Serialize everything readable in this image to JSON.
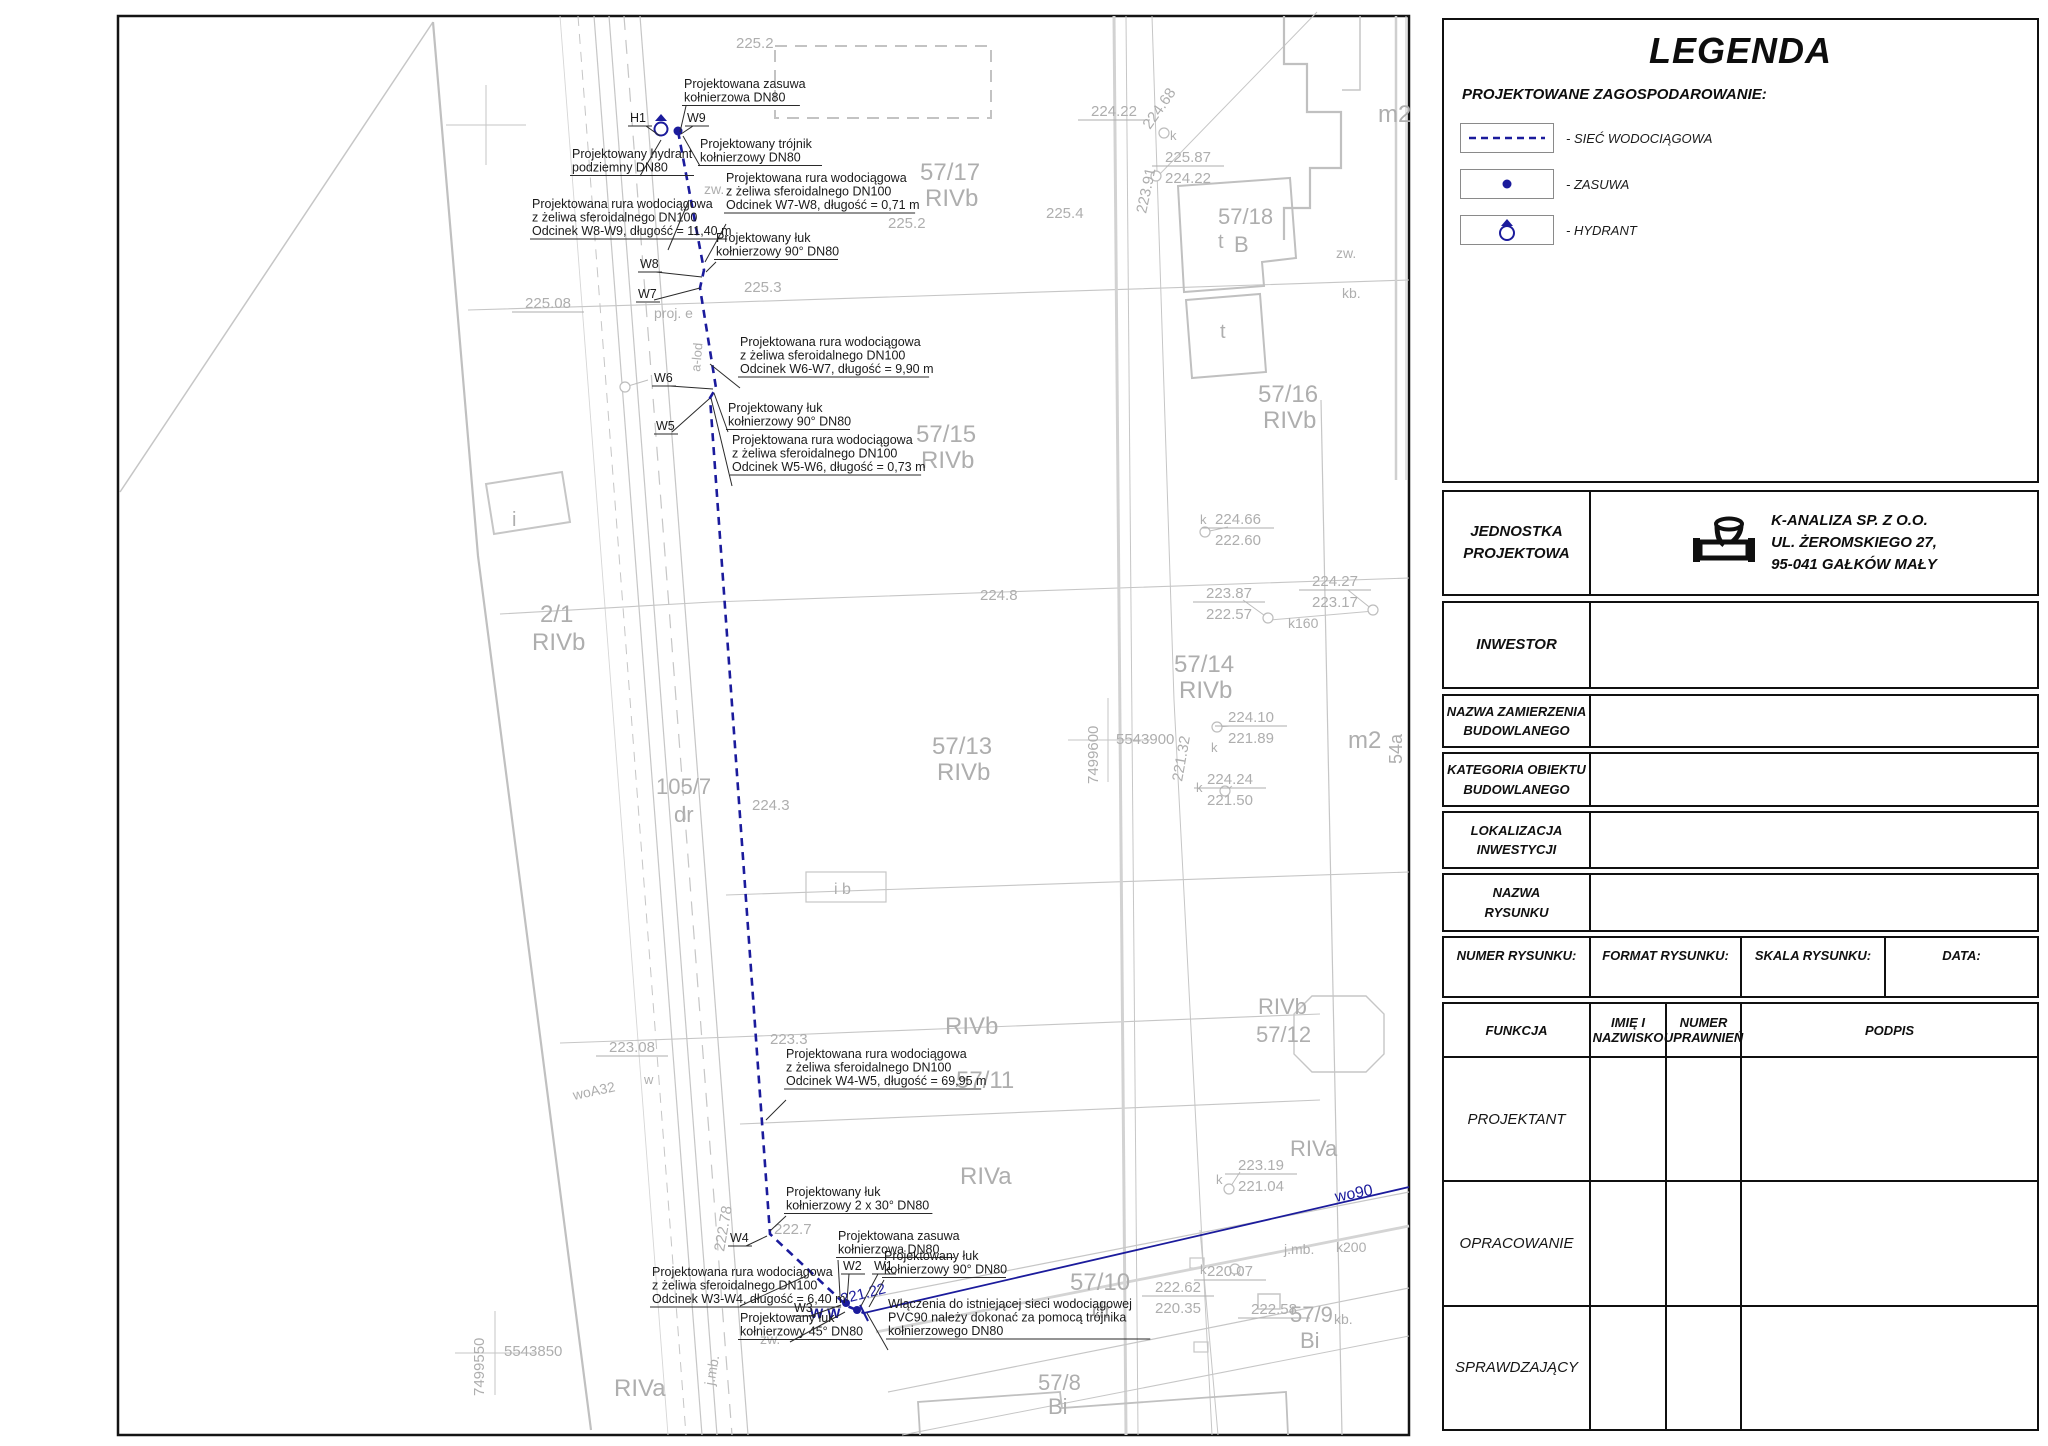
{
  "legend": {
    "title": "LEGENDA",
    "section": "PROJEKTOWANE ZAGOSPODAROWANIE:",
    "items": [
      {
        "icon": "dashed-line",
        "label": "- SIEĆ WODOCIĄGOWA"
      },
      {
        "icon": "valve-dot",
        "label": "- ZASUWA"
      },
      {
        "icon": "hydrant",
        "label": "- HYDRANT"
      }
    ]
  },
  "title_block": {
    "jednostka_label": "JEDNOSTKA\nPROJEKTOWA",
    "company": "K-ANALIZA SP. Z O.O.\nUL. ŻEROMSKIEGO 27,\n95-041 GAŁKÓW MAŁY",
    "inwestor_label": "INWESTOR",
    "nazwa_zamierzenia_label": "NAZWA ZAMIERZENIA\nBUDOWLANEGO",
    "kategoria_label": "KATEGORIA OBIEKTU\nBUDOWLANEGO",
    "lokalizacja_label": "LOKALIZACJA\nINWESTYCJI",
    "nazwa_rysunku_label": "NAZWA\nRYSUNKU",
    "numer_rysunku_label": "NUMER RYSUNKU:",
    "format_rysunku_label": "FORMAT RYSUNKU:",
    "skala_rysunku_label": "SKALA RYSUNKU:",
    "data_label": "DATA:",
    "funkcja_label": "FUNKCJA",
    "imie_label": "IMIĘ I\nNAZWISKO",
    "uprawnienia_label": "NUMER\nUPRAWNIEŃ",
    "podpis_label": "PODPIS",
    "function_rows": [
      "PROJEKTANT",
      "OPRACOWANIE",
      "SPRAWDZAJĄCY"
    ]
  },
  "map": {
    "colors": {
      "linework": "#c6c6c6",
      "gray_text": "#aeaeae",
      "network": "#1b1b9c",
      "callout_text": "#1a1a1a"
    },
    "labels": [
      {
        "t": "57/17",
        "x": 920,
        "y": 180,
        "s": 24
      },
      {
        "t": "RIVb",
        "x": 925,
        "y": 206,
        "s": 24
      },
      {
        "t": "57/15",
        "x": 916,
        "y": 442,
        "s": 24
      },
      {
        "t": "RIVb",
        "x": 921,
        "y": 468,
        "s": 24
      },
      {
        "t": "57/16",
        "x": 1258,
        "y": 402,
        "s": 24
      },
      {
        "t": "RIVb",
        "x": 1263,
        "y": 428,
        "s": 24
      },
      {
        "t": "57/14",
        "x": 1174,
        "y": 672,
        "s": 24
      },
      {
        "t": "RIVb",
        "x": 1179,
        "y": 698,
        "s": 24
      },
      {
        "t": "57/13",
        "x": 932,
        "y": 754,
        "s": 24
      },
      {
        "t": "RIVb",
        "x": 937,
        "y": 780,
        "s": 24
      },
      {
        "t": "57/18",
        "x": 1218,
        "y": 224,
        "s": 22
      },
      {
        "t": "B",
        "x": 1234,
        "y": 252,
        "s": 22
      },
      {
        "t": "2/1",
        "x": 540,
        "y": 622,
        "s": 24
      },
      {
        "t": "RIVb",
        "x": 532,
        "y": 650,
        "s": 24
      },
      {
        "t": "105/7",
        "x": 656,
        "y": 794,
        "s": 22
      },
      {
        "t": "dr",
        "x": 674,
        "y": 822,
        "s": 22
      },
      {
        "t": "57/11",
        "x": 956,
        "y": 1088,
        "s": 24
      },
      {
        "t": "RIVb",
        "x": 945,
        "y": 1034,
        "s": 24
      },
      {
        "t": "RIVa",
        "x": 960,
        "y": 1184,
        "s": 24
      },
      {
        "t": "RIVb",
        "x": 1258,
        "y": 1014,
        "s": 22
      },
      {
        "t": "57/12",
        "x": 1256,
        "y": 1042,
        "s": 22
      },
      {
        "t": "RIVa",
        "x": 1290,
        "y": 1156,
        "s": 22
      },
      {
        "t": "57/10",
        "x": 1070,
        "y": 1290,
        "s": 24
      },
      {
        "t": "dr",
        "x": 1092,
        "y": 1318,
        "s": 22
      },
      {
        "t": "57/8",
        "x": 1038,
        "y": 1390,
        "s": 22
      },
      {
        "t": "Bi",
        "x": 1048,
        "y": 1414,
        "s": 22
      },
      {
        "t": "57/9",
        "x": 1290,
        "y": 1322,
        "s": 22
      },
      {
        "t": "Bi",
        "x": 1300,
        "y": 1348,
        "s": 22
      },
      {
        "t": "RIVa",
        "x": 614,
        "y": 1396,
        "s": 24
      },
      {
        "t": "m2",
        "x": 1378,
        "y": 122,
        "s": 24
      },
      {
        "t": "m2",
        "x": 1348,
        "y": 748,
        "s": 24
      },
      {
        "t": "i",
        "x": 512,
        "y": 526,
        "s": 20
      },
      {
        "t": "i b",
        "x": 834,
        "y": 894,
        "s": 16
      },
      {
        "t": "54a",
        "x": 1402,
        "y": 764,
        "s": 18,
        "r": -90
      },
      {
        "t": "t",
        "x": 1218,
        "y": 248,
        "s": 20
      },
      {
        "t": "t",
        "x": 1220,
        "y": 338,
        "s": 20
      },
      {
        "t": "zw.",
        "x": 704,
        "y": 194,
        "s": 14
      },
      {
        "t": "zw.",
        "x": 1336,
        "y": 258,
        "s": 14
      },
      {
        "t": "kb.",
        "x": 1342,
        "y": 298,
        "s": 14
      },
      {
        "t": "zw.",
        "x": 760,
        "y": 1344,
        "s": 14
      },
      {
        "t": "kb.",
        "x": 1334,
        "y": 1324,
        "s": 14
      },
      {
        "t": "j.mb.",
        "x": 1284,
        "y": 1254,
        "s": 14
      },
      {
        "t": "k200",
        "x": 1336,
        "y": 1252,
        "s": 14
      },
      {
        "t": "j.mb.",
        "x": 714,
        "y": 1386,
        "s": 14,
        "r": -80
      },
      {
        "t": "k160",
        "x": 1288,
        "y": 628,
        "s": 14
      },
      {
        "t": "k",
        "x": 1170,
        "y": 140,
        "s": 13
      },
      {
        "t": "k",
        "x": 1200,
        "y": 524,
        "s": 13
      },
      {
        "t": "k",
        "x": 1211,
        "y": 752,
        "s": 13
      },
      {
        "t": "k",
        "x": 1196,
        "y": 792,
        "s": 13
      },
      {
        "t": "k",
        "x": 1216,
        "y": 1184,
        "s": 13
      },
      {
        "t": "k",
        "x": 1200,
        "y": 1274,
        "s": 13
      },
      {
        "t": "w",
        "x": 644,
        "y": 1084,
        "s": 13
      },
      {
        "t": "woA32",
        "x": 574,
        "y": 1100,
        "s": 14,
        "r": -12
      },
      {
        "t": "proj. e",
        "x": 654,
        "y": 318,
        "s": 14
      },
      {
        "t": "a-lod",
        "x": 700,
        "y": 372,
        "s": 13,
        "r": -85
      },
      {
        "t": "225.2",
        "x": 736,
        "y": 48,
        "s": 15
      },
      {
        "t": "225.4",
        "x": 1046,
        "y": 218,
        "s": 15
      },
      {
        "t": "225.2",
        "x": 888,
        "y": 228,
        "s": 15
      },
      {
        "t": "225.3",
        "x": 744,
        "y": 292,
        "s": 15
      },
      {
        "t": "224.8",
        "x": 980,
        "y": 600,
        "s": 15
      },
      {
        "t": "224.3",
        "x": 752,
        "y": 810,
        "s": 15
      },
      {
        "t": "223.3",
        "x": 770,
        "y": 1044,
        "s": 15
      },
      {
        "t": "222.7",
        "x": 774,
        "y": 1234,
        "s": 15
      },
      {
        "t": "224.68",
        "x": 1150,
        "y": 130,
        "s": 15,
        "r": -55
      },
      {
        "t": "223.91",
        "x": 1146,
        "y": 214,
        "s": 15,
        "r": -78
      },
      {
        "t": "221.32",
        "x": 1182,
        "y": 782,
        "s": 15,
        "r": -80
      },
      {
        "t": "222.78",
        "x": 724,
        "y": 1252,
        "s": 15,
        "r": -80
      },
      {
        "t": "7499600",
        "x": 1098,
        "y": 784,
        "s": 15,
        "r": -90
      },
      {
        "t": "5543900",
        "x": 1116,
        "y": 744,
        "s": 15
      },
      {
        "t": "7499550",
        "x": 484,
        "y": 1396,
        "s": 15,
        "r": -90
      },
      {
        "t": "5543850",
        "x": 504,
        "y": 1356,
        "s": 15
      },
      {
        "t": "wo90",
        "x": 1336,
        "y": 1202,
        "s": 16,
        "r": -11,
        "c": "blue"
      },
      {
        "t": "221.22",
        "x": 842,
        "y": 1304,
        "s": 15,
        "r": -14,
        "c": "blue"
      },
      {
        "t": "W W",
        "x": 810,
        "y": 1318,
        "s": 14,
        "c": "blue",
        "b": true
      }
    ],
    "elevations": [
      {
        "x": 1238,
        "y": 524,
        "top": "224.66",
        "bottom": "222.60"
      },
      {
        "x": 1229,
        "y": 598,
        "top": "223.87",
        "bottom": "222.57"
      },
      {
        "x": 1335,
        "y": 586,
        "top": "224.27",
        "bottom": "223.17"
      },
      {
        "x": 1251,
        "y": 722,
        "top": "224.10",
        "bottom": "221.89"
      },
      {
        "x": 1230,
        "y": 784,
        "top": "224.24",
        "bottom": "221.50"
      },
      {
        "x": 1261,
        "y": 1170,
        "top": "223.19",
        "bottom": "221.04"
      },
      {
        "x": 1178,
        "y": 1292,
        "top": "222.62",
        "bottom": "220.35"
      },
      {
        "x": 1188,
        "y": 162,
        "top": "225.87",
        "bottom": "224.22"
      },
      {
        "x": 1114,
        "y": 116,
        "top": "224.22",
        "bottom": null
      },
      {
        "x": 548,
        "y": 308,
        "top": "225.08",
        "bottom": null
      },
      {
        "x": 632,
        "y": 1052,
        "top": "223.08",
        "bottom": null
      },
      {
        "x": 1230,
        "y": 1276,
        "top": "220.07",
        "bottom": null
      },
      {
        "x": 1274,
        "y": 1314,
        "top": "222.58",
        "bottom": null
      }
    ],
    "callouts": [
      {
        "x": 684,
        "y": 88,
        "lines": [
          "Projektowana zasuwa",
          "kołnierzowa DN80"
        ],
        "leader": [
          [
            686,
            106
          ],
          [
            680,
            132
          ]
        ]
      },
      {
        "x": 630,
        "y": 122,
        "lines": [
          "H1"
        ],
        "leader": [
          [
            646,
            126
          ],
          [
            660,
            136
          ]
        ]
      },
      {
        "x": 687,
        "y": 122,
        "lines": [
          "W9"
        ],
        "leader": [
          [
            693,
            126
          ],
          [
            681,
            134
          ]
        ]
      },
      {
        "x": 572,
        "y": 158,
        "lines": [
          "Projektowany hydrant",
          "podziemny DN80"
        ],
        "leader": [
          [
            640,
            176
          ],
          [
            661,
            140
          ]
        ]
      },
      {
        "x": 700,
        "y": 148,
        "lines": [
          "Projektowany trójnik",
          "kołnierzowy DN80"
        ],
        "leader": [
          [
            700,
            166
          ],
          [
            683,
            136
          ]
        ]
      },
      {
        "x": 726,
        "y": 182,
        "lines": [
          "Projektowana rura wodociągowa",
          "z żeliwa sferoidalnego DN100",
          "Odcinek W7-W8, długość = 0,71 m"
        ],
        "leader": [
          [
            726,
            224
          ],
          [
            705,
            262
          ]
        ]
      },
      {
        "x": 532,
        "y": 208,
        "lines": [
          "Projektowana rura wodociągowa",
          "z żeliwa sferoidalnego DN100",
          "Odcinek W8-W9, długość = 11,40 m"
        ],
        "leader": [
          [
            668,
            250
          ],
          [
            689,
            200
          ]
        ]
      },
      {
        "x": 716,
        "y": 242,
        "lines": [
          "Projektowany łuk",
          "kołnierzowy 90° DN80"
        ],
        "leader": [
          [
            716,
            262
          ],
          [
            706,
            272
          ]
        ]
      },
      {
        "x": 640,
        "y": 268,
        "lines": [
          "W8"
        ],
        "leader": [
          [
            656,
            272
          ],
          [
            702,
            277
          ]
        ]
      },
      {
        "x": 638,
        "y": 298,
        "lines": [
          "W7"
        ],
        "leader": [
          [
            654,
            300
          ],
          [
            700,
            288
          ]
        ]
      },
      {
        "x": 740,
        "y": 346,
        "lines": [
          "Projektowana rura wodociągowa",
          "z żeliwa sferoidalnego DN100",
          "Odcinek W6-W7, długość = 9,90 m"
        ],
        "leader": [
          [
            740,
            388
          ],
          [
            710,
            364
          ]
        ]
      },
      {
        "x": 654,
        "y": 382,
        "lines": [
          "W6"
        ],
        "leader": [
          [
            670,
            386
          ],
          [
            713,
            389
          ]
        ]
      },
      {
        "x": 656,
        "y": 430,
        "lines": [
          "W5"
        ],
        "leader": [
          [
            672,
            432
          ],
          [
            709,
            399
          ]
        ]
      },
      {
        "x": 728,
        "y": 412,
        "lines": [
          "Projektowany łuk",
          "kołnierzowy 90° DN80"
        ],
        "leader": [
          [
            728,
            432
          ],
          [
            714,
            393
          ]
        ]
      },
      {
        "x": 732,
        "y": 444,
        "lines": [
          "Projektowana rura wodociągowa",
          "z żeliwa sferoidalnego DN100",
          "Odcinek W5-W6, długość = 0,73 m"
        ],
        "leader": [
          [
            732,
            486
          ],
          [
            711,
            398
          ]
        ]
      },
      {
        "x": 786,
        "y": 1058,
        "lines": [
          "Projektowana rura wodociągowa",
          "z żeliwa sferoidalnego DN100",
          "Odcinek W4-W5, długość = 69,95 m"
        ],
        "leader": [
          [
            786,
            1100
          ],
          [
            766,
            1120
          ]
        ]
      },
      {
        "x": 786,
        "y": 1196,
        "lines": [
          "Projektowany łuk",
          "kołnierzowy 2 x 30° DN80"
        ],
        "leader": [
          [
            786,
            1216
          ],
          [
            770,
            1231
          ]
        ]
      },
      {
        "x": 730,
        "y": 1242,
        "lines": [
          "W4"
        ],
        "leader": [
          [
            746,
            1246
          ],
          [
            767,
            1236
          ]
        ]
      },
      {
        "x": 838,
        "y": 1240,
        "lines": [
          "Projektowana zasuwa",
          "kołnierzowa DN80"
        ],
        "leader": [
          [
            838,
            1260
          ],
          [
            840,
            1296
          ]
        ]
      },
      {
        "x": 843,
        "y": 1270,
        "lines": [
          "W2"
        ],
        "leader": [
          [
            849,
            1274
          ],
          [
            847,
            1301
          ]
        ]
      },
      {
        "x": 874,
        "y": 1270,
        "lines": [
          "W1"
        ],
        "leader": [
          [
            878,
            1274
          ],
          [
            861,
            1306
          ]
        ]
      },
      {
        "x": 884,
        "y": 1260,
        "lines": [
          "Projektowany łuk",
          "kołnierzowy 90° DN80"
        ],
        "leader": [
          [
            884,
            1280
          ],
          [
            869,
            1307
          ]
        ]
      },
      {
        "x": 652,
        "y": 1276,
        "lines": [
          "Projektowana rura wodociągowa",
          "z żeliwa sferoidalnego DN100",
          "Odcinek W3-W4, długość = 6,40 m"
        ],
        "leader": [
          [
            740,
            1306
          ],
          [
            806,
            1276
          ]
        ]
      },
      {
        "x": 794,
        "y": 1312,
        "lines": [
          "W3"
        ],
        "leader": [
          [
            810,
            1316
          ],
          [
            841,
            1305
          ]
        ]
      },
      {
        "x": 740,
        "y": 1322,
        "lines": [
          "Projektowany łuk",
          "kołnierzowy 45° DN80"
        ],
        "leader": [
          [
            790,
            1342
          ],
          [
            845,
            1312
          ]
        ]
      },
      {
        "x": 888,
        "y": 1308,
        "lines": [
          "Włączenia do istniejącej sieci wodociągowej",
          "PVC90 należy dokonać za pomocą trójnika",
          "kołnierzowego DN80"
        ],
        "leader": [
          [
            888,
            1350
          ],
          [
            867,
            1313
          ]
        ]
      }
    ]
  }
}
